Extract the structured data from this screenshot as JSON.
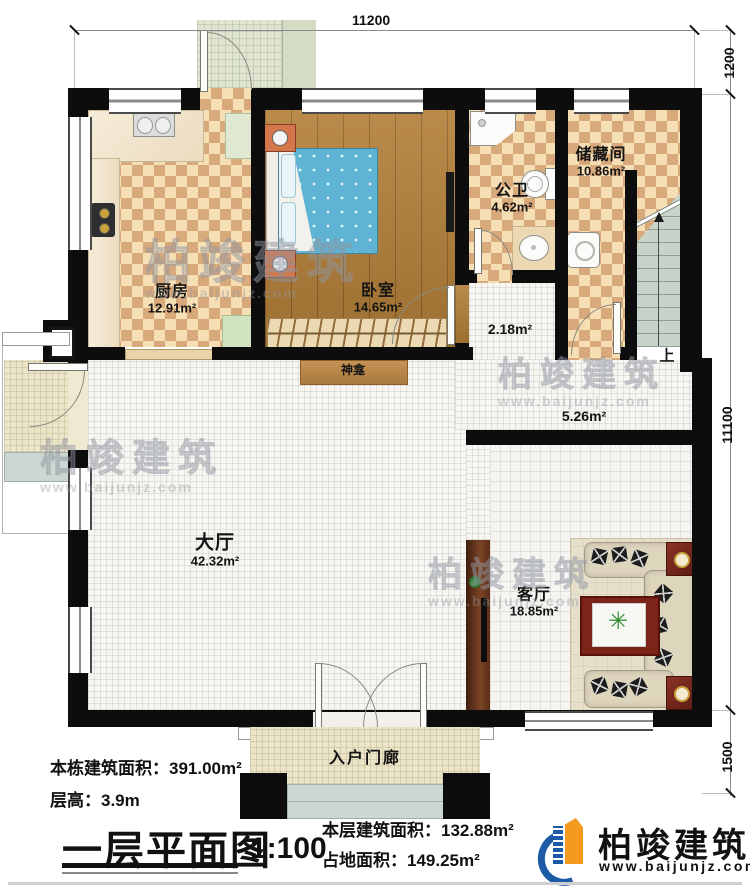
{
  "dimensions": {
    "top": "11200",
    "right_top": "1200",
    "right_middle": "11100",
    "right_bottom": "1500"
  },
  "rooms": {
    "kitchen": {
      "name": "厨房",
      "area": "12.91m²"
    },
    "bedroom": {
      "name": "卧室",
      "area": "14.65m²"
    },
    "bathroom": {
      "name": "公卫",
      "area": "4.62m²"
    },
    "storage": {
      "name": "储藏间",
      "area": "10.86m²"
    },
    "hall": {
      "name": "大厅",
      "area": "42.32m²"
    },
    "living": {
      "name": "客厅",
      "area": "18.85m²"
    },
    "corridor_small": {
      "area": "2.18m²"
    },
    "corridor_large": {
      "area": "5.26m²"
    }
  },
  "annotations": {
    "shrine": "神龛",
    "stairs_up": "上",
    "entry_porch": "入户门廊"
  },
  "footer": {
    "building_area_label": "本栋建筑面积：",
    "building_area": "391.00m²",
    "floor_height_label": "层高：",
    "floor_height": "3.9m",
    "title": "一层平面图",
    "scale": "1:100",
    "floor_area_label": "本层建筑面积：",
    "floor_area": "132.88m²",
    "land_area_label": "占地面积：",
    "land_area": "149.25m²"
  },
  "brand": {
    "name": "柏竣建筑",
    "url": "www.baijunjz.com"
  },
  "watermark": {
    "name": "柏竣建筑",
    "url": "www.baijunjz.com"
  },
  "colors": {
    "wall": "#0d0d0d",
    "brand_blue": "#1d5ba6",
    "brand_orange": "#f59a1e",
    "checker_dark": "#d7a97b",
    "checker_light": "#f6dfb4",
    "wood_floor": "#b27e37"
  }
}
